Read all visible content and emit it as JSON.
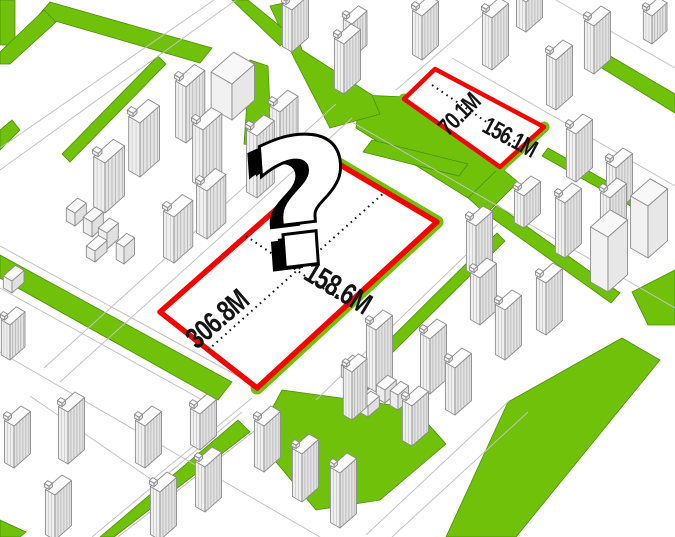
{
  "diagram": {
    "plots": {
      "main": {
        "length_label": "306.8M",
        "width_label": "158.6M"
      },
      "secondary": {
        "width_label": "70.1M",
        "length_label": "156.1M"
      }
    },
    "colors": {
      "plot_outline": "#f20400",
      "greenery": "#6fc10a"
    },
    "icons": {
      "question_mark": "?"
    }
  }
}
